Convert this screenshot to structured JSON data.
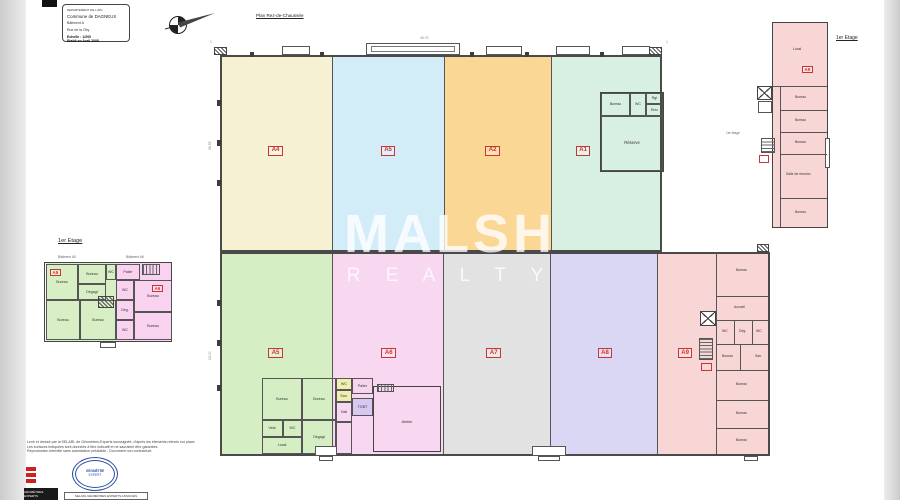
{
  "title_block": {
    "department": "DEPARTEMENT DE L'AIN",
    "commune": "Commune de DAGNEUX",
    "building": "Bâtiment A",
    "address": "Rue de la Oby",
    "scale": "Echelle : 1/200",
    "date": "Etabli en Avril 2008"
  },
  "plan_title": "Plan Rez-de-Chaussée",
  "watermark": {
    "line1": "MALSH",
    "line2": "R E A L T Y"
  },
  "ground_floor": {
    "zones": [
      {
        "id": "A4",
        "color": "#f6f1d3"
      },
      {
        "id": "A5",
        "color": "#d2ecf8"
      },
      {
        "id": "A2",
        "color": "#fbd795"
      },
      {
        "id": "A1",
        "color": "#d8f0e2"
      },
      {
        "id": "A5",
        "color": "#d6eec3"
      },
      {
        "id": "A6",
        "color": "#f8d7f0"
      },
      {
        "id": "A7",
        "color": "#e2e2e2"
      },
      {
        "id": "A8",
        "color": "#dad7f4"
      },
      {
        "id": "A9",
        "color": "#f8d6d6"
      }
    ],
    "suite_a1_rooms": [
      "Bureau",
      "WC",
      "Rgt",
      "Elec",
      "Réserve"
    ],
    "office_block_rooms": [
      "Bureau",
      "Bureau",
      "WC",
      "San.",
      "Hall",
      "Vest.",
      "WC",
      "Local",
      "Dégagt",
      "Palier",
      "TGBT",
      "Atelier"
    ],
    "right_wing_rooms": [
      "Bureau",
      "Accueil",
      "WC",
      "Dég.",
      "WC",
      "Bureau",
      "San.",
      "Bureau",
      "Bureau",
      "Bureau"
    ],
    "dims": {
      "top": "45.70",
      "left": "36.55",
      "left2": "24.00"
    },
    "grid_marks": [
      "1",
      "1"
    ]
  },
  "floor1_left": {
    "title": "1er Etage",
    "caption_a5": "Bâtiment A5",
    "caption_a6": "Bâtiment A6",
    "zone_a5": {
      "id": "A5",
      "color": "#d8efc6"
    },
    "zone_a6": {
      "id": "A6",
      "color": "#f8d2ee"
    },
    "rooms": [
      "Bureau",
      "Bureau",
      "WC",
      "Dégagt",
      "Bureau",
      "Bureau",
      "Palier",
      "WC",
      "Bureau",
      "Dég.",
      "Bureau",
      "WC"
    ]
  },
  "floor1_right": {
    "title": "1er Etage",
    "side_note": "1er étage",
    "zone": {
      "id": "A9",
      "color": "#f8d6d6"
    },
    "rooms": [
      "Local",
      "Bureau",
      "Bureau",
      "Bureau",
      "Salle de réunion",
      "Bureau"
    ]
  },
  "footer": {
    "notes": [
      "Levé et dressé par la SELARL de Géomètres-Experts soussignée, d'après les éléments relevés sur place.",
      "Les surfaces indiquées sont données à titre indicatif et ne sauraient être garanties.",
      "Reproduction interdite sans autorisation préalable - Document non contractuel."
    ],
    "oge_banner": "GÉOMÈTRES-EXPERTS",
    "seal": {
      "line1": "GÉOMÈTRE",
      "line2": "EXPERT"
    },
    "firm_box": "SELARL GÉOMÈTRES EXPERTS ASSOCIÉS"
  },
  "colors": {
    "wall": "#4a4a4a",
    "zone_label": "#cc3333",
    "yellow_cell": "#f0edb2",
    "purple_cell": "#d6c8f0",
    "pink_cell": "#f6d4ee",
    "seal_blue": "#2b4ea8",
    "edge_strip": "#d9d9d9",
    "watermark": "rgba(255,255,255,0.75)"
  }
}
